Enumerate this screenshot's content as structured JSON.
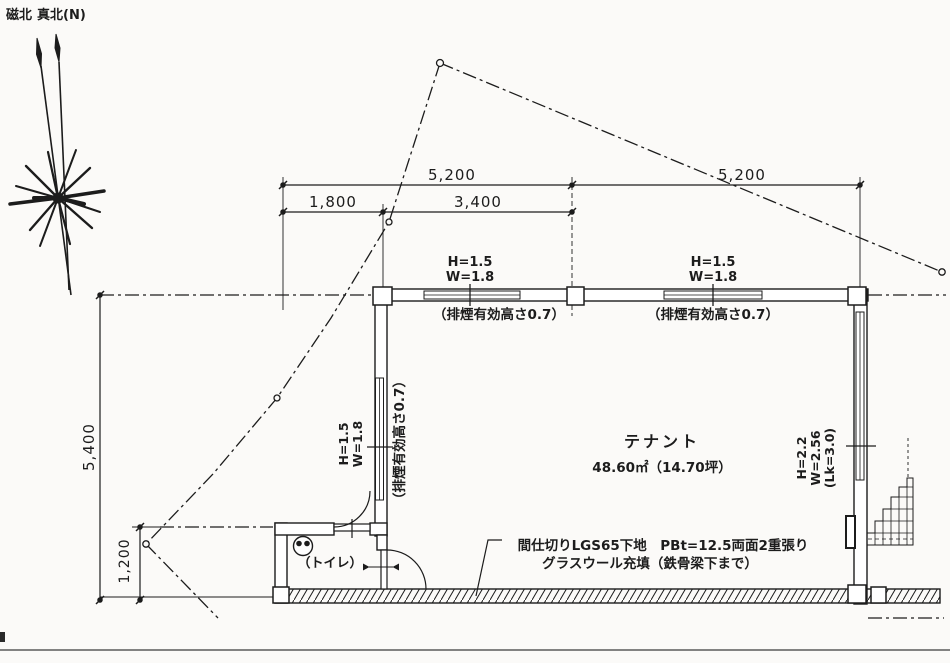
{
  "compass": {
    "magnetic_north": "磁北",
    "true_north": "真北(N)"
  },
  "dims": {
    "span_left": "5,200",
    "span_right": "5,200",
    "sub_left": "1,800",
    "sub_right": "3,400",
    "height_total": "5,400",
    "toilet_depth": "1,200"
  },
  "openings": {
    "top_left": {
      "h": "H=1.5",
      "w": "W=1.8",
      "note": "（排煙有効高さ0.7）"
    },
    "top_right": {
      "h": "H=1.5",
      "w": "W=1.8",
      "note": "（排煙有効高さ0.7）"
    },
    "left": {
      "h": "H=1.5",
      "w": "W=1.8",
      "note": "（排煙有効高さ0.7）"
    },
    "right": {
      "h": "H=2.2",
      "w": "W=2.56",
      "lk": "(Lk=3.0)"
    }
  },
  "rooms": {
    "tenant_name": "テナント",
    "tenant_area": "48.60㎡（14.70坪）",
    "toilet_name": "（トイレ）"
  },
  "notes": {
    "partition_1": "間仕切りLGS65下地　PBt=12.5両面2重張り",
    "partition_2": "グラスウール充填（鉄骨梁下まで）"
  },
  "colors": {
    "ink": "#1c1c1c",
    "paper": "#fbfaf8"
  }
}
